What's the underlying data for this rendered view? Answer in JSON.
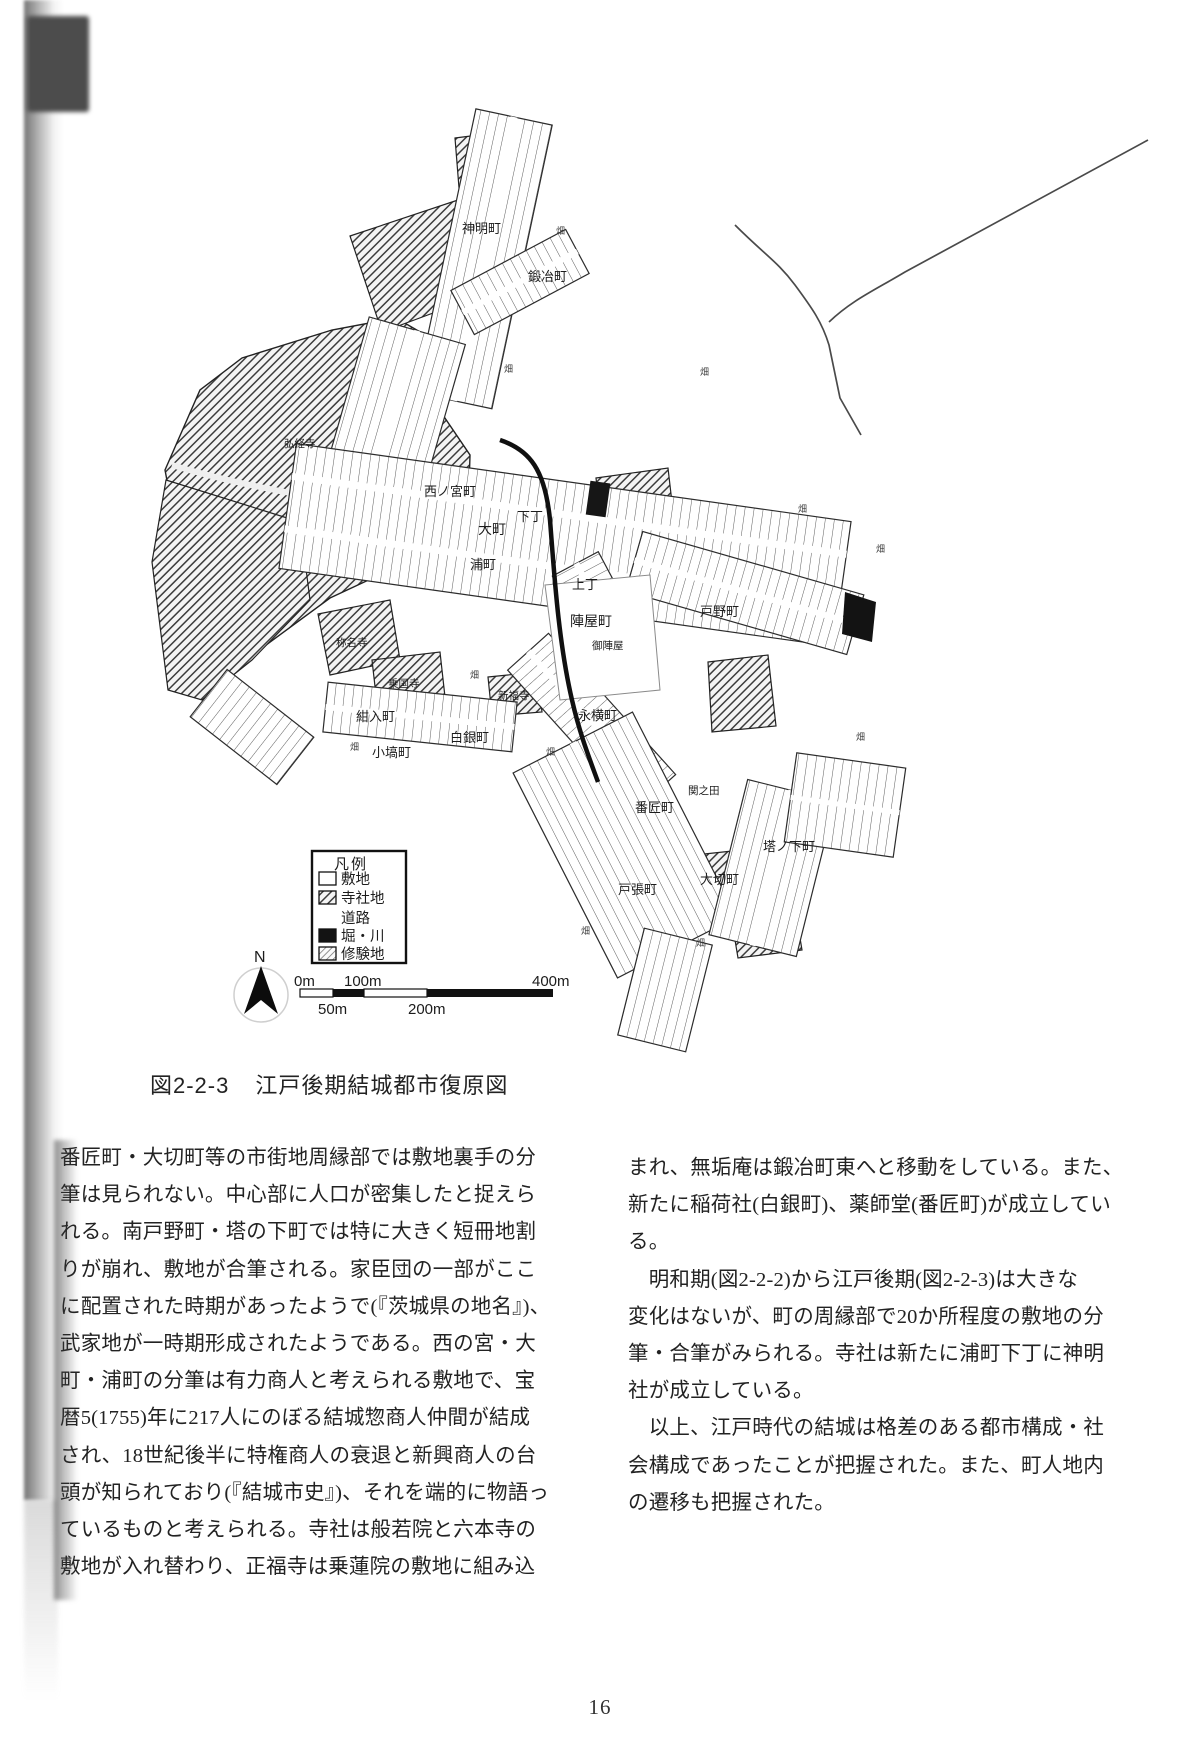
{
  "page": {
    "number": "16"
  },
  "figure": {
    "caption_no": "図2-2-3",
    "caption_title": "江戸後期結城都市復原図",
    "legend": {
      "title": "凡例",
      "items": [
        {
          "label": "敷地",
          "swatch": "white"
        },
        {
          "label": "寺社地",
          "swatch": "hatch"
        },
        {
          "label": "道路",
          "swatch": "none"
        },
        {
          "label": "堀・川",
          "swatch": "black"
        },
        {
          "label": "修験地",
          "swatch": "fine-hatch"
        }
      ]
    },
    "compass": {
      "label": "N"
    },
    "scale_bar": {
      "top_labels": [
        "0m",
        "100m",
        "400m"
      ],
      "bottom_labels": [
        "50m",
        "200m"
      ]
    },
    "map_labels": {
      "shinmei": "神明町",
      "kaji": "鍛冶町",
      "nishinomiya": "西ノ宮町",
      "omachi": "大町",
      "shimocho": "下丁",
      "kamicho": "上丁",
      "uramachi": "浦町",
      "jinyamachi": "陣屋町",
      "gojinya": "御陣屋",
      "tonomachi": "戸野町",
      "nagayokocho": "永横町",
      "sekinota": "関之田",
      "banshomachi": "番匠町",
      "okirimachi": "大切町",
      "tonoshitamachi": "塔ノ下町",
      "tobaricho": "戸張町",
      "kobanamachi": "小塙町",
      "shiroganemachi": "白銀町",
      "konirimachi": "紺入町",
      "shomyoji": "称名寺",
      "jokokuji": "乗国寺",
      "shinpukuji": "新福寺",
      "gukyoji": "弘経寺",
      "hata": "畑"
    }
  },
  "body": {
    "left_column": [
      "番匠町・大切町等の市街地周縁部では敷地裏手の分",
      "筆は見られない。中心部に人口が密集したと捉えら",
      "れる。南戸野町・塔の下町では特に大きく短冊地割",
      "りが崩れ、敷地が合筆される。家臣団の一部がここ",
      "に配置された時期があったようで(『茨城県の地名』)、",
      "武家地が一時期形成されたようである。西の宮・大",
      "町・浦町の分筆は有力商人と考えられる敷地で、宝",
      "暦5(1755)年に217人にのぼる結城惣商人仲間が結成",
      "され、18世紀後半に特権商人の衰退と新興商人の台",
      "頭が知られており(『結城市史』)、それを端的に物語っ",
      "ているものと考えられる。寺社は般若院と六本寺の",
      "敷地が入れ替わり、正福寺は乗蓮院の敷地に組み込"
    ],
    "right_column": [
      "まれ、無垢庵は鍛冶町東へと移動をしている。また、",
      "新たに稲荷社(白銀町)、薬師堂(番匠町)が成立してい",
      "る。",
      "　明和期(図2-2-2)から江戸後期(図2-2-3)は大きな",
      "変化はないが、町の周縁部で20か所程度の敷地の分",
      "筆・合筆がみられる。寺社は新たに浦町下丁に神明",
      "社が成立している。",
      "　以上、江戸時代の結城は格差のある都市構成・社",
      "会構成であったことが把握された。また、町人地内",
      "の遷移も把握された。"
    ]
  }
}
